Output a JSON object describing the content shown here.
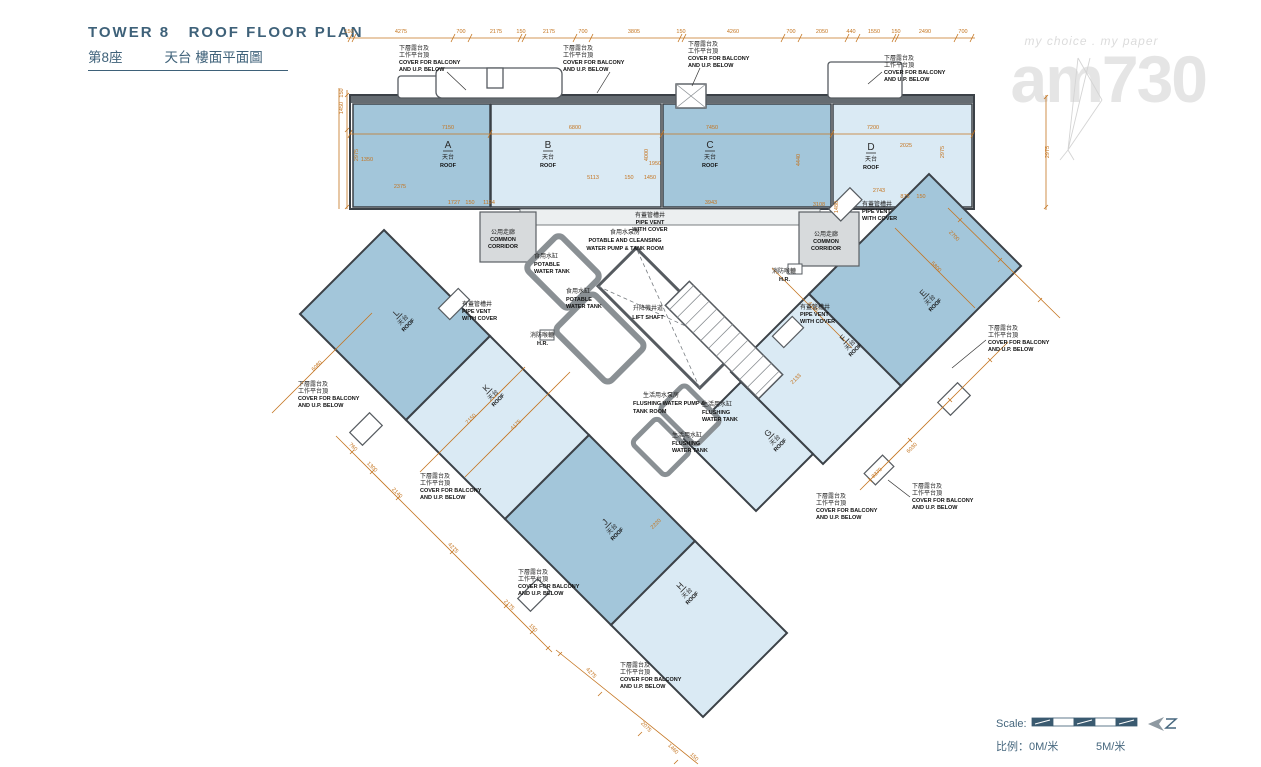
{
  "header": {
    "title_en": "TOWER 8   ROOF FLOOR PLAN",
    "title_zh_tower": "第8座",
    "title_zh_name": "天台 樓面平面圖"
  },
  "watermark": {
    "tagline": "my choice . my paper",
    "logo": "am730"
  },
  "roofs": {
    "zh": "天台",
    "en": "ROOF",
    "letters": [
      "A",
      "B",
      "C",
      "D",
      "E",
      "F",
      "G",
      "H",
      "J",
      "K",
      "L"
    ]
  },
  "annotations": {
    "cover": [
      "下層露台及",
      "工作平台頂",
      "COVER FOR BALCONY",
      "AND U.P. BELOW"
    ],
    "common_corridor": [
      "公用走廊",
      "COMMON",
      "CORRIDOR"
    ],
    "pipe_vent": [
      "有蓋管槽井",
      "PIPE VENT",
      "WITH COVER"
    ],
    "potable_pump": [
      "食用水泵房",
      "POTABLE AND CLEANSING",
      "WATER PUMP & TANK ROOM"
    ],
    "potable_tank": [
      "食用水缸",
      "POTABLE",
      "WATER TANK"
    ],
    "lift_shaft": [
      "升降機井道",
      "LIFT SHAFT"
    ],
    "flushing_pump": [
      "生活用水泵房",
      "FLUSHING WATER PUMP &",
      "TANK ROOM"
    ],
    "flushing_tank": [
      "生活用水缸",
      "FLUSHING",
      "WATER TANK"
    ],
    "hose_reel": [
      "消防喉轆",
      "H.R."
    ]
  },
  "scale": {
    "label": "Scale:",
    "zh": "比例：0M/米",
    "five": "5M/米"
  },
  "dims": [
    "150",
    "4275",
    "700",
    "2175",
    "150",
    "2175",
    "700",
    "3805",
    "150",
    "4260",
    "700",
    "2050",
    "440",
    "1550",
    "150",
    "2490",
    "700",
    "7150",
    "6800",
    "7450",
    "7200",
    "2975",
    "4000",
    "4440",
    "2975",
    "2975",
    "1480",
    "2025",
    "2743",
    "875",
    "150",
    "1950",
    "5113",
    "150",
    "1450",
    "3943",
    "3108",
    "2375",
    "1727",
    "150",
    "1124",
    "1350",
    "7150",
    "4175",
    "6080",
    "2220",
    "2133",
    "6030",
    "8370",
    "5800",
    "4135",
    "2700",
    "760",
    "1300",
    "2140",
    "4275",
    "2175",
    "150",
    "4275",
    "2075",
    "1460",
    "150",
    "1450",
    "150"
  ]
}
